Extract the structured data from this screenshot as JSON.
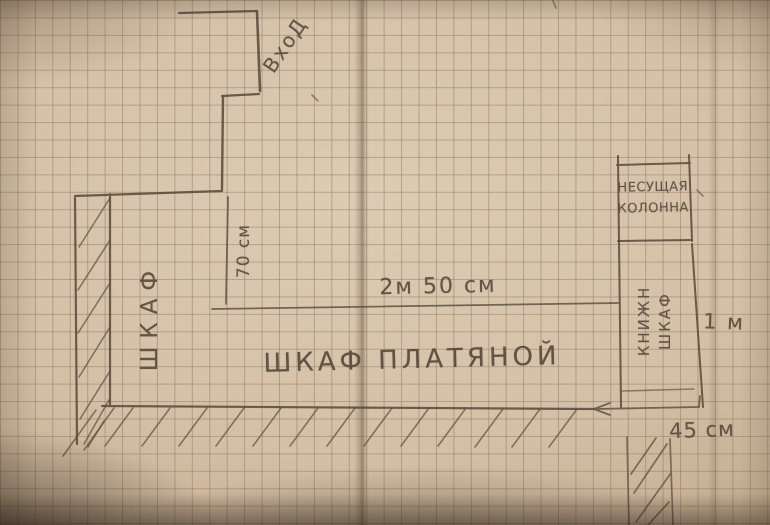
{
  "title": "Hand-drawn pencil floor plan on graph paper",
  "labels": {
    "entrance": "ВхоД",
    "wardrobe_side": "ШКАФ",
    "wardrobe_main": "ШКАФ ПЛАТЯНОЙ",
    "column_line1": "НЕСУЩАЯ",
    "column_line2": "КОЛОННА",
    "bookcase_line1": "КНИЖН",
    "bookcase_line2": "ШКАФ"
  },
  "dimensions": {
    "niche_depth": "70 см",
    "wardrobe_length": "2м 50 см",
    "bookcase_height": "1 м",
    "bookcase_depth": "45 см"
  },
  "colors": {
    "paper": "#d4c0a7",
    "grid_line": "#82674c",
    "pencil": "#55483a"
  }
}
